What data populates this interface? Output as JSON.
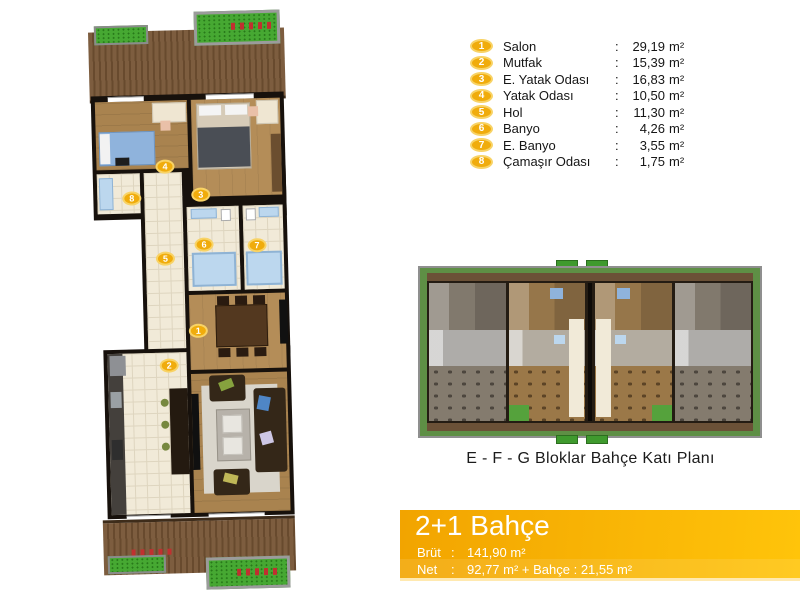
{
  "legend": {
    "colon": ":",
    "unit": "m²",
    "items": [
      {
        "num": "1",
        "label": "Salon",
        "area": "29,19"
      },
      {
        "num": "2",
        "label": "Mutfak",
        "area": "15,39"
      },
      {
        "num": "3",
        "label": "E. Yatak Odası",
        "area": "16,83"
      },
      {
        "num": "4",
        "label": "Yatak Odası",
        "area": "10,50"
      },
      {
        "num": "5",
        "label": "Hol",
        "area": "11,30"
      },
      {
        "num": "6",
        "label": "Banyo",
        "area": "4,26"
      },
      {
        "num": "7",
        "label": "E. Banyo",
        "area": "3,55"
      },
      {
        "num": "8",
        "label": "Çamaşır Odası",
        "area": "1,75"
      }
    ]
  },
  "key_plan": {
    "caption": "E - F - G Bloklar Bahçe Katı Planı"
  },
  "banner": {
    "title": "2+1 Bahçe",
    "colon": ":",
    "brut_label": "Brüt",
    "brut_value": "141,90 m²",
    "net_label": "Net",
    "net_value": "92,77 m² + Bahçe : 21,55 m²"
  },
  "colors": {
    "gold": "#F0AC0C",
    "green": "#46A832",
    "orange_left": "#F2A400",
    "orange_right": "#FFC40A",
    "cream": "#F1EAD8",
    "blue": "#BCD7EE"
  }
}
